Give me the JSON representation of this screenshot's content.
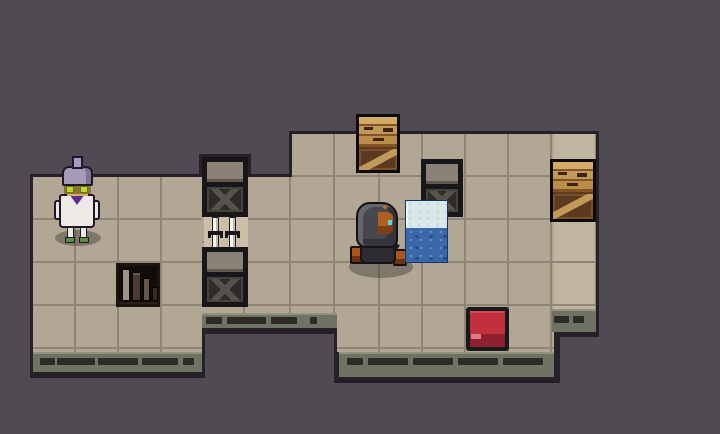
{
  "meta": {
    "width": 720,
    "height": 434,
    "scene": "pixel-art dungeon room scene with two tiled rooms joined by a corridor",
    "background_color": "#504a53"
  },
  "palette": {
    "background": "#504a53",
    "room_outline": "#262029",
    "tile": "#b2a795",
    "tile_seam": "#8e8574",
    "tile_light_column": "#c0b59e",
    "tile_candle": "#c9bea6",
    "wall_strip": "#6f7364",
    "wall_strip_highlight": "#8e927e",
    "wall_vent_dash": "#2e2a25",
    "crate_frame": "#17171a",
    "crate_lid": "#8a8277",
    "crate_panel": "#2d2c29",
    "crate_brace": "#55534b",
    "wood": "#c1995b",
    "wood_dark": "#835325",
    "wood_deep": "#5d3a1f",
    "ice_border": "#16356b",
    "ice": "#dbe8e9",
    "water": "#3a69a9",
    "button_red": "#c2303e",
    "button_red_dark": "#8e2130",
    "button_base": "#17171c",
    "wizard_hair": "#a49cba",
    "wizard_robe": "#edeae5",
    "wizard_scarf": "#5f2d92",
    "wizard_lens_green": "#c3d22c",
    "wizard_shoe": "#5e8f3c",
    "hood_gray": "#47474d",
    "face_orange": "#ad5f21",
    "eye_cyan": "#4fd9e6",
    "boot_orange": "#a9571d"
  },
  "layout": {
    "outline-left-room": {
      "x": 30,
      "y": 174,
      "w": 175,
      "h": 204
    },
    "outline-corridor": {
      "x": 199,
      "y": 154,
      "w": 52,
      "h": 180
    },
    "outline-corridor-strip": {
      "x": 199,
      "y": 310,
      "w": 144,
      "h": 24
    },
    "outline-mid-notch": {
      "x": 245,
      "y": 174,
      "w": 50,
      "h": 142
    },
    "outline-step-column": {
      "x": 289,
      "y": 131,
      "w": 51,
      "h": 185
    },
    "outline-main-room": {
      "x": 334,
      "y": 131,
      "w": 226,
      "h": 252
    },
    "outline-right-column": {
      "x": 551,
      "y": 131,
      "w": 48,
      "h": 206
    },
    "floor-left-room": {
      "x": 33,
      "y": 177,
      "w": 169,
      "h": 175
    },
    "floor-corridor": {
      "x": 202,
      "y": 157,
      "w": 46,
      "h": 156
    },
    "floor-mid-notch": {
      "x": 248,
      "y": 177,
      "w": 44,
      "h": 136
    },
    "floor-step-column": {
      "x": 292,
      "y": 134,
      "w": 45,
      "h": 179
    },
    "floor-main-room": {
      "x": 337,
      "y": 134,
      "w": 217,
      "h": 218
    },
    "floor-right-column": {
      "x": 554,
      "y": 134,
      "w": 42,
      "h": 175
    },
    "candle-tile": {
      "x": 204,
      "y": 217,
      "w": 44,
      "h": 31
    },
    "strip-left-room": {
      "x": 33,
      "y": 352,
      "w": 169,
      "h": 20
    },
    "strip-corridor": {
      "x": 202,
      "y": 313,
      "w": 135,
      "h": 15
    },
    "strip-main-room": {
      "x": 339,
      "y": 352,
      "w": 215,
      "h": 25
    },
    "strip-right-column": {
      "x": 552,
      "y": 309,
      "w": 44,
      "h": 23
    },
    "wizard-npc": {
      "x": 52,
      "y": 156,
      "w": 50,
      "h": 92
    },
    "bookshelf": {
      "x": 116,
      "y": 263,
      "w": 44,
      "h": 44
    },
    "dark-crate-top": {
      "x": 202,
      "y": 157,
      "w": 46,
      "h": 60
    },
    "swords": {
      "x": 208,
      "y": 217,
      "w": 34,
      "h": 31
    },
    "dark-crate-bottom": {
      "x": 202,
      "y": 247,
      "w": 46,
      "h": 60
    },
    "wooden-crate-top": {
      "x": 356,
      "y": 114,
      "w": 44,
      "h": 59
    },
    "dark-crate-right": {
      "x": 421,
      "y": 159,
      "w": 42,
      "h": 58
    },
    "wooden-crate-right": {
      "x": 550,
      "y": 159,
      "w": 46,
      "h": 63
    },
    "hooded-player": {
      "x": 348,
      "y": 200,
      "w": 66,
      "h": 80
    },
    "water-block": {
      "x": 405,
      "y": 200,
      "w": 43,
      "h": 63
    },
    "red-button": {
      "x": 466,
      "y": 307,
      "w": 43,
      "h": 44
    }
  },
  "strips": {
    "strip-left-room": {
      "dash_y": 6,
      "dashes": [
        [
          7,
          15
        ],
        [
          24,
          38
        ],
        [
          65,
          40
        ],
        [
          109,
          36
        ],
        [
          150,
          11
        ]
      ]
    },
    "strip-corridor": {
      "dash_y": 4,
      "dashes": [
        [
          4,
          16
        ],
        [
          25,
          39
        ],
        [
          69,
          26
        ],
        [
          108,
          7
        ]
      ]
    },
    "strip-main-room": {
      "dash_y": 6,
      "dashes": [
        [
          8,
          16
        ],
        [
          29,
          40
        ],
        [
          74,
          40
        ],
        [
          119,
          40
        ],
        [
          164,
          40
        ]
      ]
    },
    "strip-right-column": {
      "dash_y": 7,
      "dashes": [
        [
          2,
          15
        ],
        [
          21,
          11
        ]
      ]
    }
  },
  "entities": [
    {
      "name": "wizard-npc",
      "label": "white-robed wizard NPC with lavender hair bun and green glasses",
      "tile_pos": "left room"
    },
    {
      "name": "hooded-player",
      "label": "hooded character facing right with cyan eye and orange boots",
      "tile_pos": "main room"
    },
    {
      "name": "water-block",
      "label": "pushable ice/water tank block",
      "tile_pos": "right of player"
    },
    {
      "name": "red-button",
      "label": "red floor switch on dark base",
      "tile_pos": "main room bottom"
    },
    {
      "name": "bookshelf",
      "label": "recessed shelf with four book spines",
      "tile_pos": "left room"
    },
    {
      "name": "swords",
      "label": "two white swords planted in floor tile",
      "tile_pos": "corridor"
    },
    {
      "name": "dark-crate-top",
      "label": "dark crate with X brace and gray lid"
    },
    {
      "name": "dark-crate-bottom",
      "label": "dark crate with X brace and gray lid"
    },
    {
      "name": "dark-crate-right",
      "label": "dark crate with X brace and gray lid"
    },
    {
      "name": "wooden-crate-top",
      "label": "wooden crate with diagonal brace"
    },
    {
      "name": "wooden-crate-right",
      "label": "wooden crate with diagonal brace"
    }
  ]
}
